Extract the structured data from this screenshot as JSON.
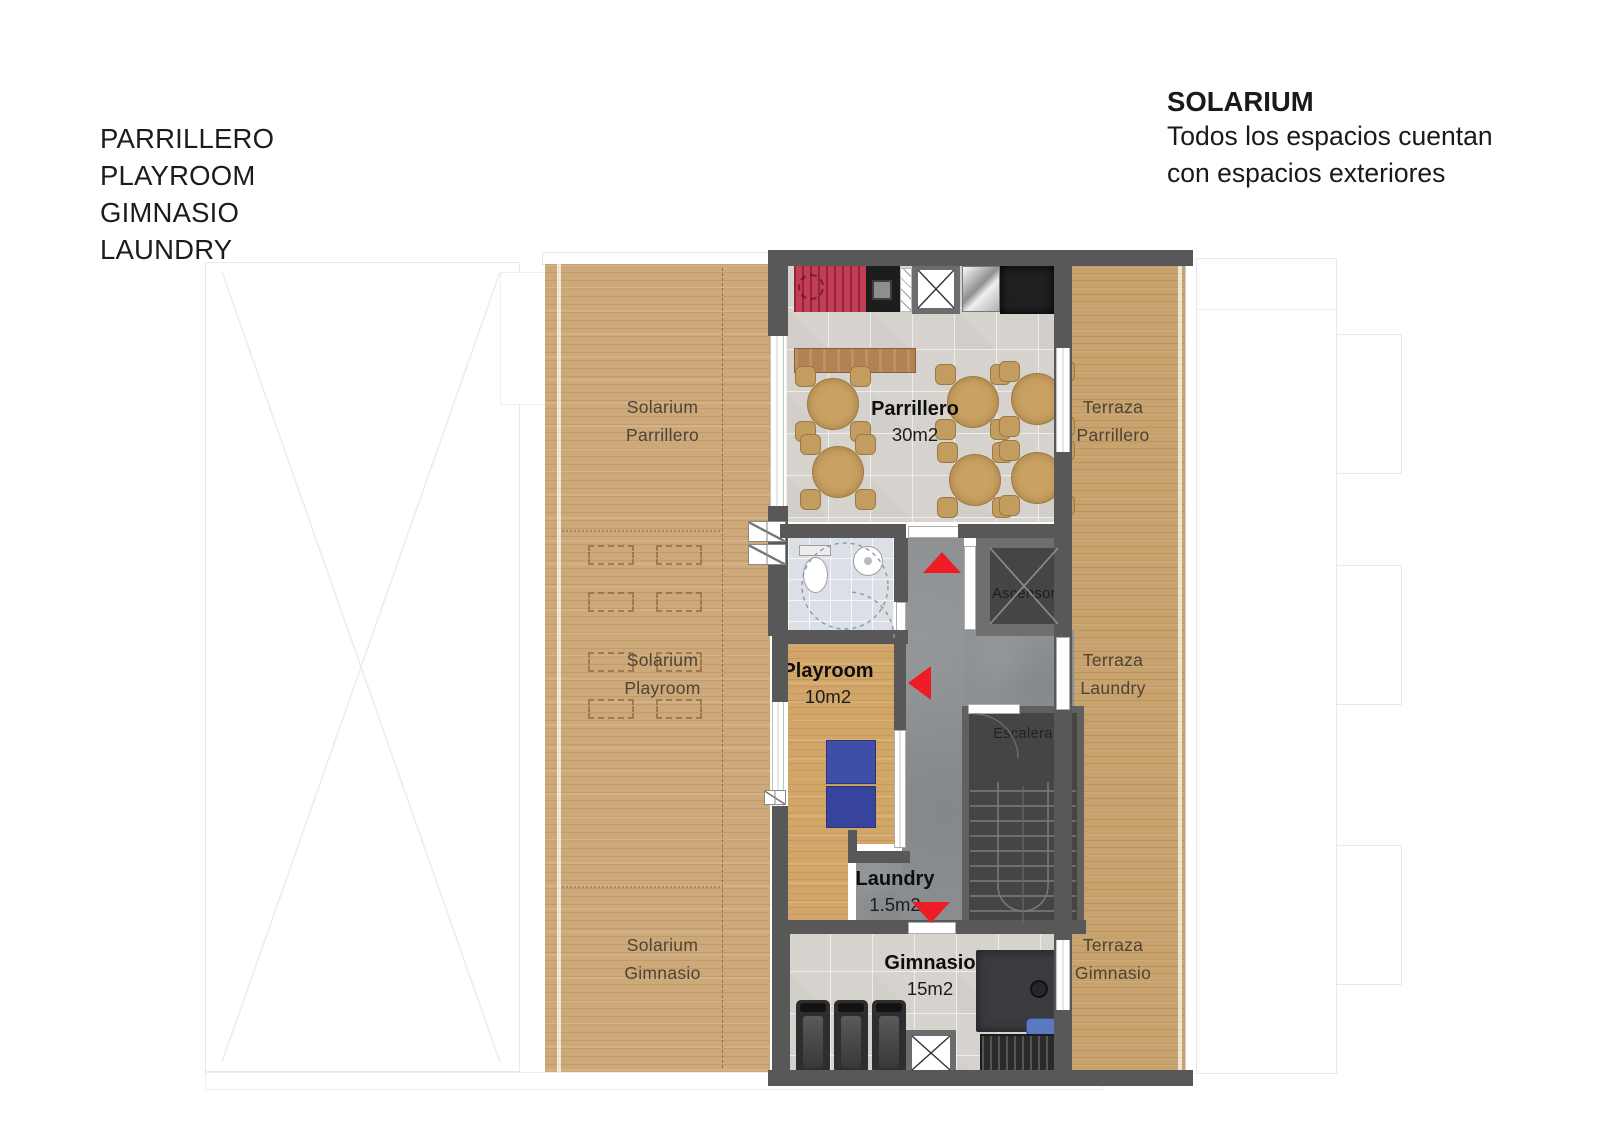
{
  "legend": {
    "lines": [
      "PARRILLERO",
      "PLAYROOM",
      "GIMNASIO",
      "LAUNDRY"
    ]
  },
  "title_block": {
    "title": "SOLARIUM",
    "line1": "Todos los espacios cuentan",
    "line2": "con espacios exteriores"
  },
  "rooms": {
    "solarium_parrillero": {
      "line1": "Solarium",
      "line2": "Parrillero"
    },
    "parrillero": {
      "name": "Parrillero",
      "area": "30m2"
    },
    "terraza_parrillero": {
      "line1": "Terraza",
      "line2": "Parrillero"
    },
    "ascensor": {
      "name": "Ascensor"
    },
    "solarium_playroom": {
      "line1": "Solarium",
      "line2": "Playroom"
    },
    "playroom": {
      "name": "Playroom",
      "area": "10m2"
    },
    "terraza_laundry": {
      "line1": "Terraza",
      "line2": "Laundry"
    },
    "escalera": {
      "name": "Escalera"
    },
    "laundry": {
      "name": "Laundry",
      "area": "1.5m2"
    },
    "solarium_gimnasio": {
      "line1": "Solarium",
      "line2": "Gimnasio"
    },
    "gimnasio": {
      "name": "Gimnasio",
      "area": "15m2"
    },
    "terraza_gimnasio": {
      "line1": "Terraza",
      "line2": "Gimnasio"
    }
  },
  "colors": {
    "wall": "#585858",
    "wood_deck": "#cda97a",
    "wood_terrace": "#c8a36e",
    "wood_playroom": "#d2a668",
    "tile_floor": "#d6d3ce",
    "bath_tile": "#dbe0e6",
    "concrete": "#8d9092",
    "stair_core": "#454545",
    "grill_red": "#c23d55",
    "arrow_red": "#ee1c25",
    "mat_blue": "#3f4fa8",
    "table_wood": "#c9a263"
  }
}
